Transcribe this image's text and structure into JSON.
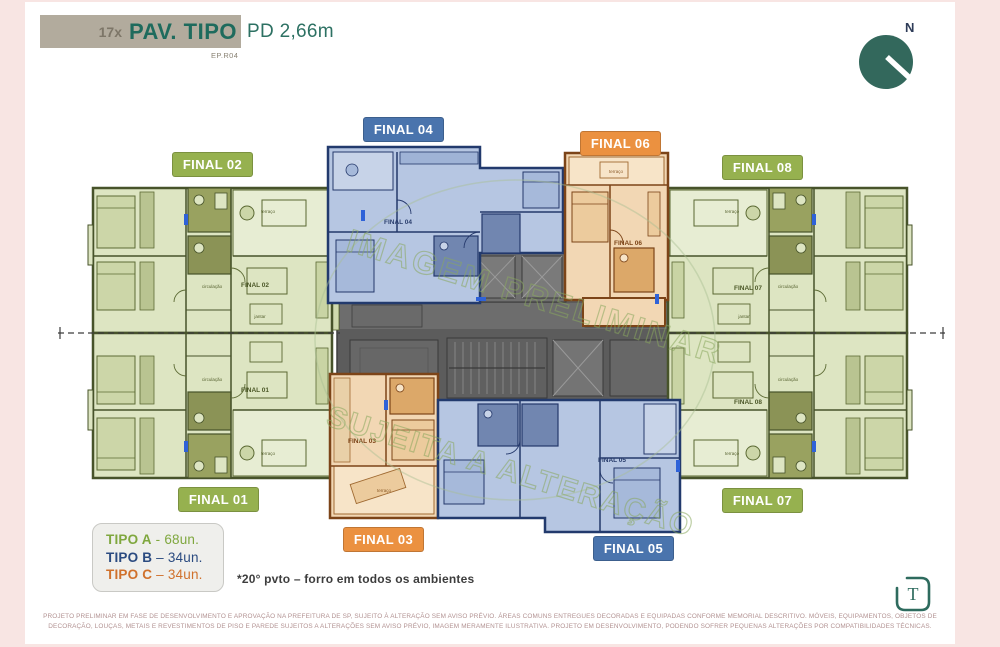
{
  "header": {
    "count": "17x",
    "title": "PAV. TIPO",
    "ceiling_height": "PD 2,66m",
    "revision": "EP.R04"
  },
  "compass": {
    "north": "N"
  },
  "watermark": {
    "line1": "IMAGEM PRELIMINAR",
    "line2": "SUJEITA A ALTERAÇÃO"
  },
  "plan": {
    "badges": [
      {
        "id": "final-02",
        "label": "FINAL 02",
        "tipo": "A",
        "color": "#96b14f"
      },
      {
        "id": "final-04",
        "label": "FINAL 04",
        "tipo": "B",
        "color": "#4a74ad"
      },
      {
        "id": "final-06",
        "label": "FINAL 06",
        "tipo": "C",
        "color": "#eb9140"
      },
      {
        "id": "final-08",
        "label": "FINAL 08",
        "tipo": "A",
        "color": "#96b14f"
      },
      {
        "id": "final-01",
        "label": "FINAL 01",
        "tipo": "A",
        "color": "#96b14f"
      },
      {
        "id": "final-03",
        "label": "FINAL 03",
        "tipo": "C",
        "color": "#eb9140"
      },
      {
        "id": "final-05",
        "label": "FINAL 05",
        "tipo": "B",
        "color": "#4a74ad"
      },
      {
        "id": "final-07",
        "label": "FINAL 07",
        "tipo": "A",
        "color": "#96b14f"
      }
    ],
    "unit_labels": {
      "f01": "FINAL 01",
      "f02": "FINAL 02",
      "f03": "FINAL 03",
      "f04": "FINAL 04",
      "f05": "FINAL 05",
      "f06": "FINAL 06",
      "f07": "FINAL 07",
      "f08": "FINAL 08"
    },
    "room_labels": {
      "terrace": "terraço",
      "circulation": "circulação",
      "dining": "jantar"
    }
  },
  "legend": {
    "items": [
      {
        "name": "TIPO A",
        "separator": "-",
        "units": "68un.",
        "color": "#7fa73e"
      },
      {
        "name": "TIPO B",
        "separator": "–",
        "units": "34un.",
        "color": "#2b4b80"
      },
      {
        "name": "TIPO C",
        "separator": "–",
        "units": "34un.",
        "color": "#d0712c"
      }
    ]
  },
  "note": "*20° pvto – forro em todos os ambientes",
  "footer": {
    "line1": "PROJETO PRELIMINAR EM FASE DE DESENVOLVIMENTO E APROVAÇÃO NA PREFEITURA DE SP, SUJEITO À ALTERAÇÃO SEM AVISO PRÉVIO. ÁREAS COMUNS ENTREGUES DECORADAS E EQUIPADAS CONFORME MEMORIAL DESCRITIVO. MÓVEIS, EQUIPAMENTOS, OBJETOS DE",
    "line2": "DECORAÇÃO, LOUÇAS, METAIS E REVESTIMENTOS DE PISO E PAREDE SUJEITOS A ALTERAÇÕES SEM AVISO PRÉVIO, IMAGEM MERAMENTE ILUSTRATIVA. PROJETO EM DESENVOLVIMENTO, PODENDO SOFRER PEQUENAS ALTERAÇÕES POR COMPATIBILIDADES TÉCNICAS."
  },
  "logo": {
    "letter": "T"
  },
  "colors": {
    "brand_teal": "#1e6b5d",
    "background_pink": "#f8e5e3",
    "header_bar": "#b2ab9d",
    "tipo_a_green": "#96b14f",
    "tipo_b_blue": "#4a74ad",
    "tipo_c_orange": "#eb9140"
  }
}
